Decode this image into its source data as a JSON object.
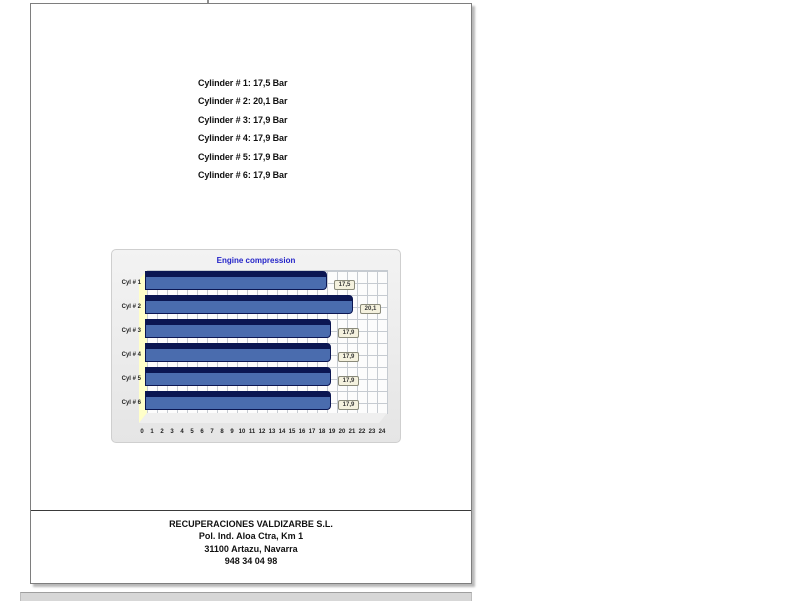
{
  "page": {
    "readings": [
      "Cylinder # 1: 17,5 Bar",
      "Cylinder # 2: 20,1 Bar",
      "Cylinder # 3: 17,9 Bar",
      "Cylinder # 4: 17,9 Bar",
      "Cylinder # 5: 17,9 Bar",
      "Cylinder # 6: 17,9 Bar"
    ],
    "footer": {
      "lines": [
        "RECUPERACIONES VALDIZARBE S.L.",
        "Pol. Ind. Aloa Ctra, Km 1",
        "31100 Artazu, Navarra",
        "948 34 04 98"
      ]
    }
  },
  "chart_data": {
    "type": "bar",
    "orientation": "horizontal",
    "title": "Engine compression",
    "categories": [
      "Cyl # 1",
      "Cyl # 2",
      "Cyl # 3",
      "Cyl # 4",
      "Cyl # 5",
      "Cyl # 6"
    ],
    "values": [
      17.5,
      20.1,
      17.9,
      17.9,
      17.9,
      17.9
    ],
    "value_labels": [
      "17,5",
      "20,1",
      "17,9",
      "17,9",
      "17,9",
      "17,9"
    ],
    "unit": "Bar",
    "xlabel": "",
    "ylabel": "",
    "xlim": [
      0,
      24
    ],
    "x_ticks": [
      0,
      1,
      2,
      3,
      4,
      5,
      6,
      7,
      8,
      9,
      10,
      11,
      12,
      13,
      14,
      15,
      16,
      17,
      18,
      19,
      20,
      21,
      22,
      23,
      24
    ],
    "grid": true,
    "legend": "none",
    "style": "3d-horizontal-bars",
    "colors": {
      "bar_face": "#4a6cae",
      "bar_top": "#0b1652",
      "left_wall": "#ffffc9",
      "title_text": "#2323c8",
      "panel_background": "#ededed",
      "value_box_background": "#f4f1de"
    }
  }
}
